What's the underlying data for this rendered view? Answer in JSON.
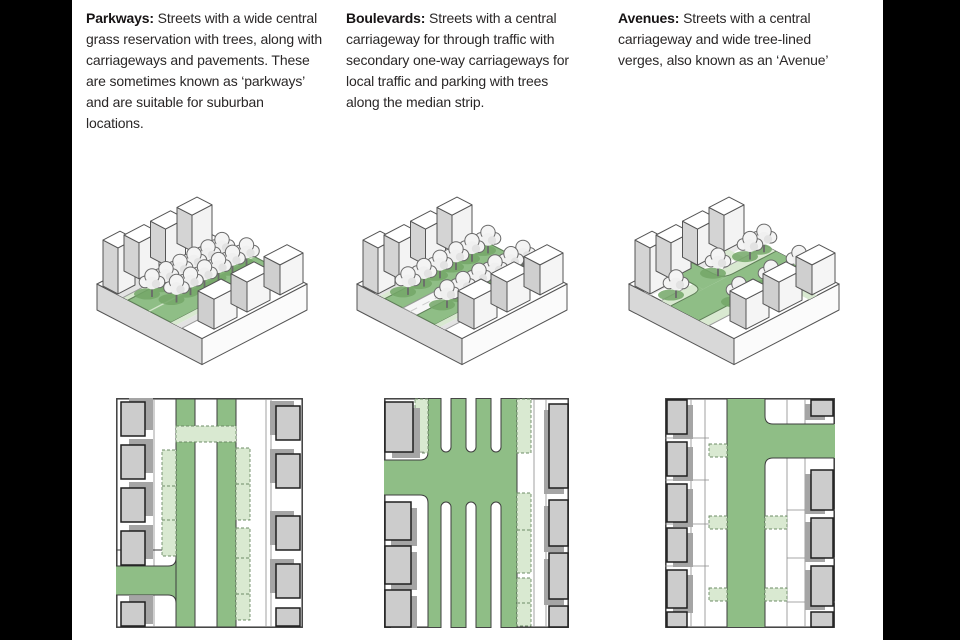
{
  "document_title": "Street types: Parkways, Boulevards and Avenues",
  "palette": {
    "letterbox": "#000000",
    "page_background": "#ffffff",
    "text": "#2a2727",
    "street_green": "#8fbe86",
    "verge_light_green": "#d9e9d1",
    "tree_shadow_green": "#74a768",
    "building_grey": "#cccccc",
    "shadow_grey": "#a5a5a5",
    "line_grey": "#4a4a4a"
  },
  "sections": [
    {
      "id": "parkways",
      "term": "Parkways:",
      "description": "Streets with a wide central grass reservation with trees, along with carriageways and pavements. These are sometimes known as ‘parkways’ and are suitable for suburban locations."
    },
    {
      "id": "boulevards",
      "term": "Boulevards:",
      "description": "Streets with a central carriageway for through traffic with secondary one-way carriageways for local traffic and parking with trees along the median strip."
    },
    {
      "id": "avenues",
      "term": "Avenues:",
      "description": "Streets with a central carriageway and wide tree-lined verges, also known as an ‘Avenue’"
    }
  ]
}
